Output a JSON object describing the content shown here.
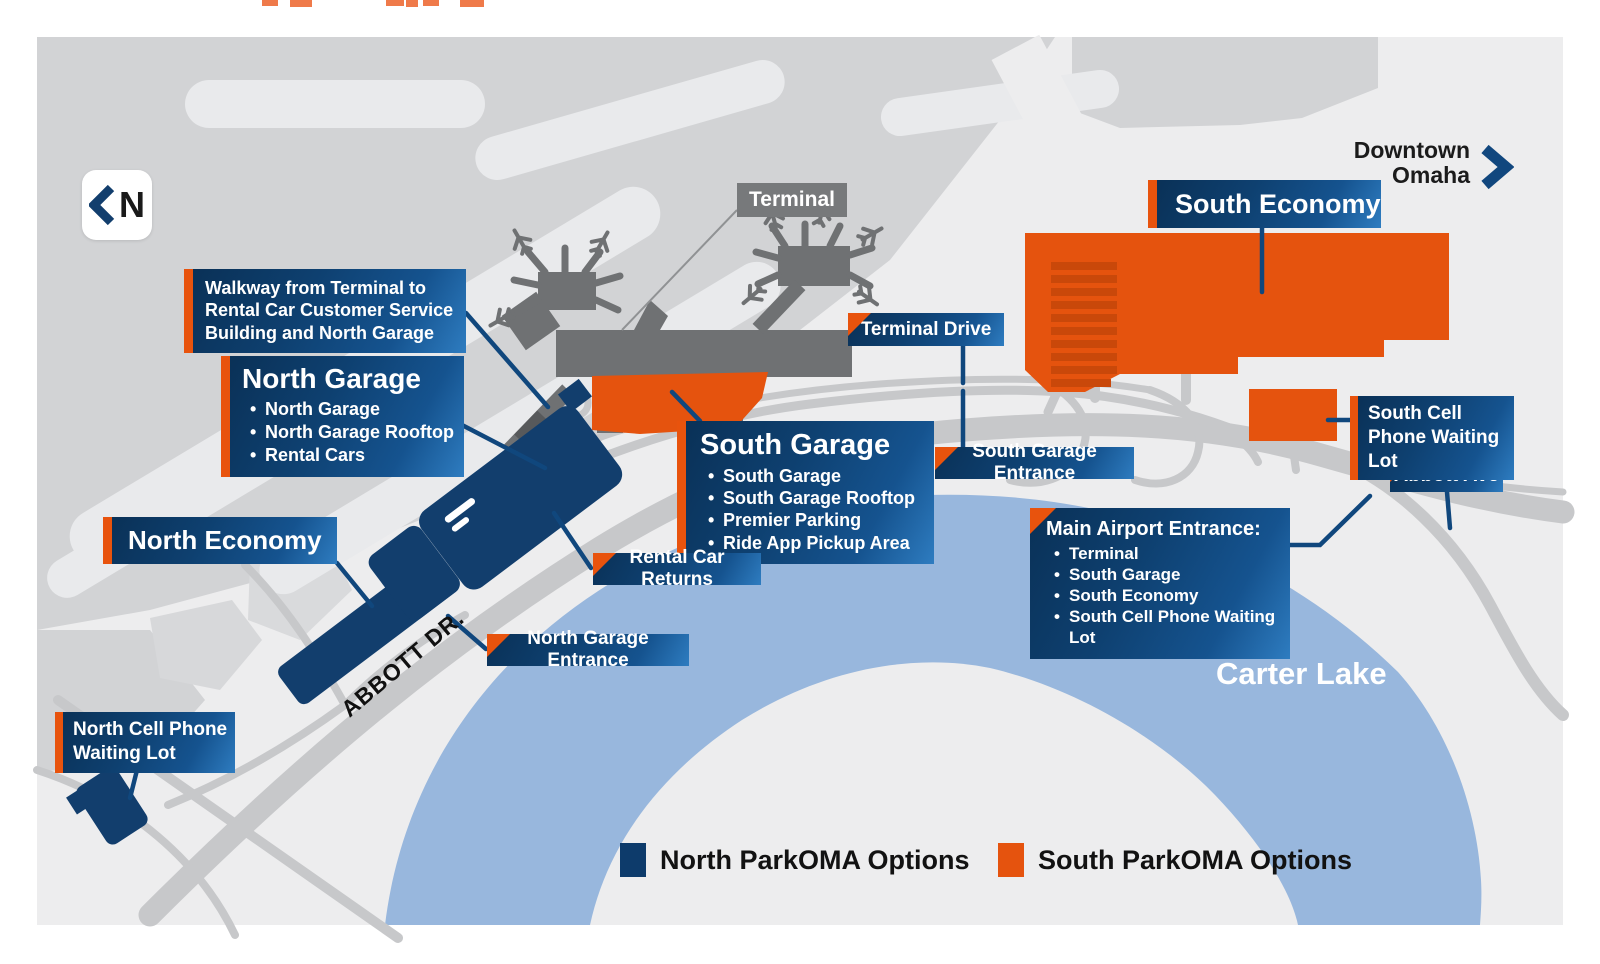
{
  "compass": {
    "label": "N"
  },
  "downtown": {
    "label": "Downtown Omaha"
  },
  "terminal": {
    "label": "Terminal"
  },
  "boxes": {
    "walkway": {
      "text": "Walkway from Terminal to Rental Car Customer Service Building and North Garage"
    },
    "north_garage": {
      "title": "North Garage",
      "bullets": [
        "North Garage",
        "North Garage Rooftop",
        "Rental Cars"
      ]
    },
    "south_garage": {
      "title": "South Garage",
      "bullets": [
        "South Garage",
        "South Garage Rooftop",
        "Premier Parking",
        "Ride App Pickup Area"
      ]
    },
    "main_airport_entrance": {
      "title": "Main Airport Entrance:",
      "bullets": [
        "Terminal",
        "South Garage",
        "South Economy",
        "South Cell Phone Waiting Lot"
      ]
    },
    "north_economy": {
      "label": "North Economy"
    },
    "south_economy": {
      "label": "South Economy"
    },
    "terminal_drive": {
      "label": "Terminal Drive"
    },
    "south_garage_entrance": {
      "label": "South Garage Entrance"
    },
    "north_garage_entrance": {
      "label": "North Garage Entrance"
    },
    "rental_car_returns": {
      "label": "Rental Car Returns"
    },
    "north_cell_phone": {
      "label": "North Cell Phone Waiting Lot"
    },
    "south_cell_phone": {
      "label": "South Cell Phone Waiting Lot"
    },
    "abbott_ave": {
      "label": "Abbott Ave"
    }
  },
  "map_text": {
    "abbott_dr": "ABBOTT DR.",
    "carter_lake": "Carter Lake"
  },
  "legend": {
    "north": {
      "label": "North ParkOMA Options",
      "color": "#0d3b6b"
    },
    "south": {
      "label": "South ParkOMA Options",
      "color": "#e5530e"
    }
  },
  "colors": {
    "north_navy": "#0d3b6b",
    "south_orange": "#e5530e",
    "lake_blue": "#98b7dd",
    "terminal_gray": "#6f7173",
    "road_gray": "#c7c8ca",
    "tarmac_gray": "#d2d3d5",
    "leader_navy": "#10477d"
  }
}
